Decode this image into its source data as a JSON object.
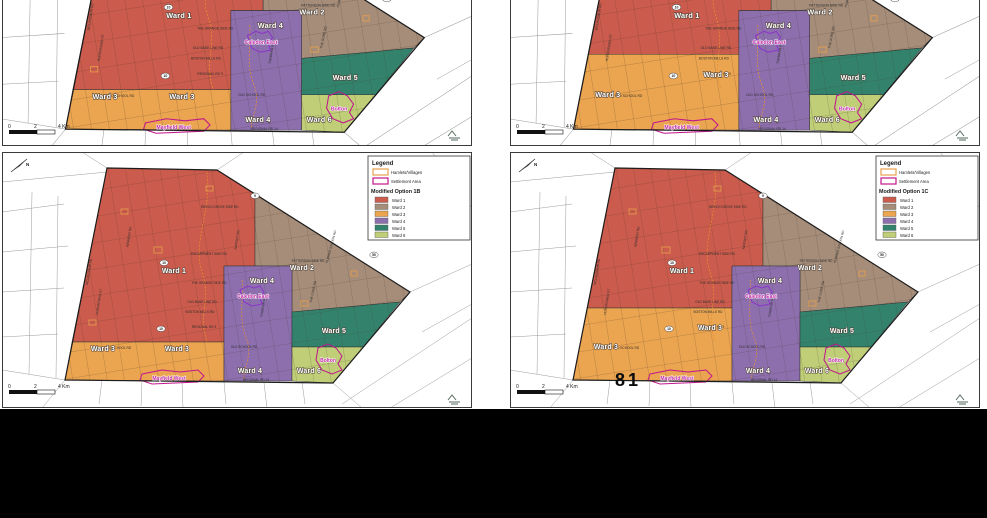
{
  "page": {
    "number": "81"
  },
  "legend": {
    "title": "Legend",
    "hamlets": "Hamlets/Villages",
    "settlement": "Settlement Area",
    "wards": [
      {
        "label": "Ward 1",
        "color": "#cb5b4c"
      },
      {
        "label": "Ward 2",
        "color": "#a68d79"
      },
      {
        "label": "Ward 3",
        "color": "#eba44f"
      },
      {
        "label": "Ward 4",
        "color": "#8d6fae"
      },
      {
        "label": "Ward 5",
        "color": "#33836c"
      },
      {
        "label": "Ward 6",
        "color": "#bfce77"
      }
    ],
    "hamlet_outline_color": "#e8a04c",
    "settlement_outline_color": "#c0168c"
  },
  "panels": {
    "top_left": {
      "option": "B"
    },
    "top_right": {
      "option": "C"
    },
    "bottom_left": {
      "option": "B",
      "legend_title": "Modified Option 1B"
    },
    "bottom_right": {
      "option": "C",
      "legend_title": "Modified Option 1C"
    }
  },
  "map": {
    "north_label": "N",
    "scale_labels": {
      "zero": "0",
      "two": "2",
      "four": "4 Km"
    },
    "ward_labels": {
      "B": [
        {
          "text": "Ward 1",
          "x": 172,
          "y": 121
        },
        {
          "text": "Ward 2",
          "x": 300,
          "y": 118
        },
        {
          "text": "Ward 4",
          "x": 260,
          "y": 131
        },
        {
          "text": "Ward 3",
          "x": 101,
          "y": 199
        },
        {
          "text": "Ward 3",
          "x": 175,
          "y": 199
        },
        {
          "text": "Ward 4",
          "x": 248,
          "y": 221
        },
        {
          "text": "Ward 5",
          "x": 332,
          "y": 181
        },
        {
          "text": "Ward 6",
          "x": 307,
          "y": 221
        }
      ],
      "C": [
        {
          "text": "Ward 1",
          "x": 172,
          "y": 121
        },
        {
          "text": "Ward 2",
          "x": 300,
          "y": 118
        },
        {
          "text": "Ward 4",
          "x": 260,
          "y": 131
        },
        {
          "text": "Ward 3",
          "x": 96,
          "y": 197
        },
        {
          "text": "Ward 3",
          "x": 200,
          "y": 178
        },
        {
          "text": "Ward 4",
          "x": 248,
          "y": 221
        },
        {
          "text": "Ward 5",
          "x": 332,
          "y": 181
        },
        {
          "text": "Ward 6",
          "x": 307,
          "y": 221
        }
      ]
    },
    "settlement_labels": [
      {
        "text": "Caledon East",
        "x": 251,
        "y": 146
      },
      {
        "text": "Bolton",
        "x": 326,
        "y": 210
      },
      {
        "text": "Mayfield West",
        "x": 167,
        "y": 228
      }
    ],
    "road_labels": [
      {
        "text": "BEECH GROVE SIDE RD",
        "x": 218,
        "y": 56
      },
      {
        "text": "ESCARPMENT SIDE RD",
        "x": 207,
        "y": 103
      },
      {
        "text": "PATTERSON SIDE RD",
        "x": 306,
        "y": 110
      },
      {
        "text": "THE GRANGE SIDE RD",
        "x": 207,
        "y": 132
      },
      {
        "text": "OLD BASE LINE RD",
        "x": 200,
        "y": 151
      },
      {
        "text": "BOSTON MILLS RD",
        "x": 198,
        "y": 161
      },
      {
        "text": "REGIONAL RD 9",
        "x": 202,
        "y": 176
      },
      {
        "text": "OLD SCHOOL RD",
        "x": 116,
        "y": 197
      },
      {
        "text": "OLD SCHOOL RD",
        "x": 242,
        "y": 196
      },
      {
        "text": "REGIONAL RD 14",
        "x": 254,
        "y": 229
      },
      {
        "text": "KENNEDY RD",
        "x": 128,
        "y": 85,
        "r": -81
      },
      {
        "text": "AIRPORT RD",
        "x": 236,
        "y": 88,
        "r": -81
      },
      {
        "text": "HURONTARIO ST",
        "x": 98,
        "y": 150,
        "r": -81
      },
      {
        "text": "TORBRAM RD",
        "x": 262,
        "y": 155,
        "r": -81
      },
      {
        "text": "THE GORE RD",
        "x": 312,
        "y": 140,
        "r": -78
      },
      {
        "text": "HUMBER STATION RD",
        "x": 330,
        "y": 95,
        "r": -75
      },
      {
        "text": "MCLAUGHLIN RD",
        "x": 88,
        "y": 120,
        "r": -81
      }
    ],
    "highway_shields": [
      {
        "text": "10",
        "x": 162,
        "y": 112
      },
      {
        "text": "9",
        "x": 253,
        "y": 45
      },
      {
        "text": "50",
        "x": 372,
        "y": 104
      },
      {
        "text": "10",
        "x": 159,
        "y": 178
      }
    ]
  }
}
